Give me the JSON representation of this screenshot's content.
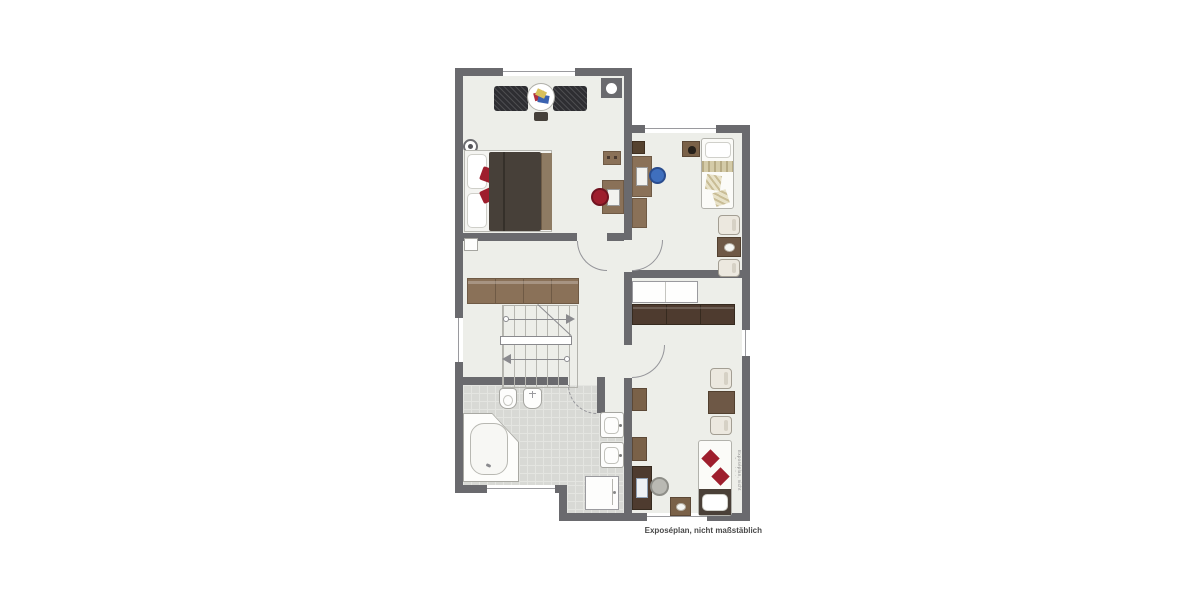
{
  "caption": "Exposéplan, nicht maßstäblich",
  "watermark": "Exposéplan, nicht maßstäblich",
  "palette": {
    "wall": "#6a6a6e",
    "floor": "#edeee9",
    "tile": "#d8d9d5",
    "tileLine": "#e4e5e1",
    "red": "#9e1e2d",
    "blue": "#3f6fbe",
    "woodLight": "#8a7158",
    "woodMid": "#7a6148",
    "woodDark": "#4e3b2f",
    "duvet": "#474039",
    "armchair": "#2e2e32",
    "cream": "#ece8df"
  }
}
